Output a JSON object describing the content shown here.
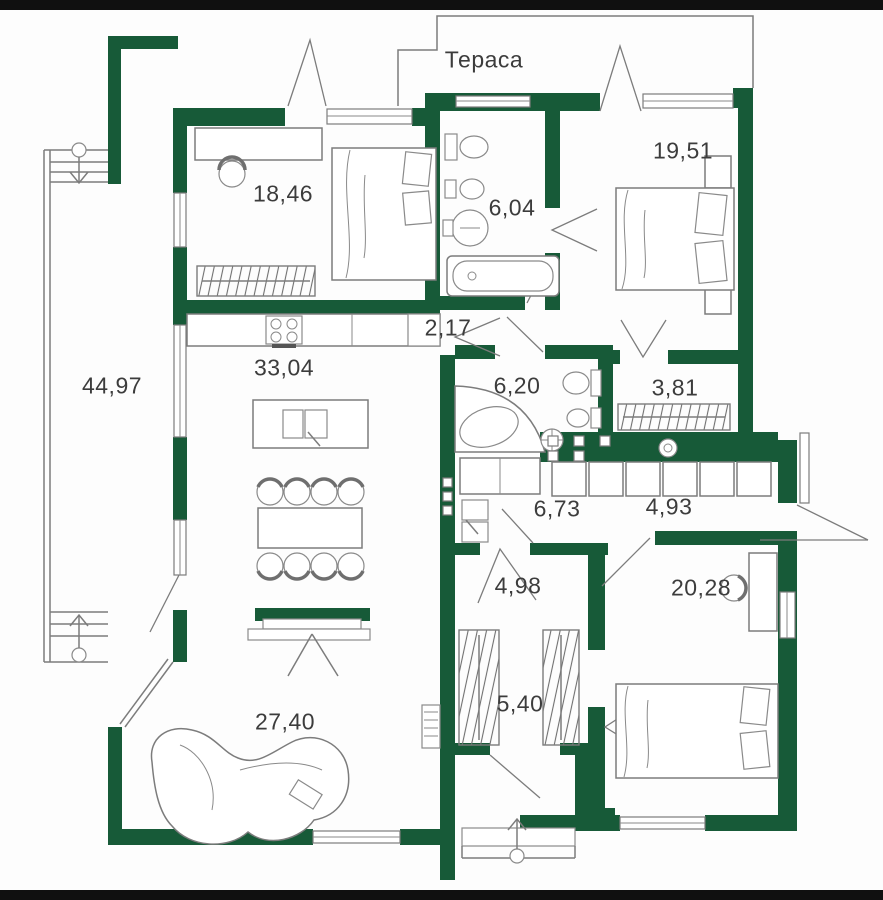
{
  "plan": {
    "title": "house-floor-plan",
    "colors": {
      "wall": "#175a38",
      "frame_bar": "#101010",
      "line": "#7c7c7c",
      "text": "#3c3c3c",
      "background": "#fdfdfd"
    },
    "rooms": [
      {
        "name": "terrace-top",
        "label": "Тераса",
        "x": 484,
        "y": 60
      },
      {
        "name": "bedroom-1",
        "area": "18,46",
        "x": 283,
        "y": 194
      },
      {
        "name": "bathroom-1",
        "area": "6,04",
        "x": 512,
        "y": 208
      },
      {
        "name": "bedroom-2",
        "area": "19,51",
        "x": 683,
        "y": 151
      },
      {
        "name": "corridor-1",
        "area": "2,17",
        "x": 448,
        "y": 328
      },
      {
        "name": "bathroom-2",
        "area": "6,20",
        "x": 517,
        "y": 386
      },
      {
        "name": "wardrobe-room",
        "area": "3,81",
        "x": 675,
        "y": 388
      },
      {
        "name": "terrace-left",
        "area": "44,97",
        "x": 112,
        "y": 386
      },
      {
        "name": "kitchen-dining",
        "area": "33,04",
        "x": 284,
        "y": 368
      },
      {
        "name": "utility-room",
        "area": "6,73",
        "x": 557,
        "y": 509
      },
      {
        "name": "entrance-hall",
        "area": "4,93",
        "x": 669,
        "y": 507
      },
      {
        "name": "corridor-2",
        "area": "4,98",
        "x": 518,
        "y": 586
      },
      {
        "name": "hallway-closet",
        "area": "5,40",
        "x": 520,
        "y": 704
      },
      {
        "name": "living-room",
        "area": "27,40",
        "x": 285,
        "y": 722
      },
      {
        "name": "bedroom-3",
        "area": "20,28",
        "x": 701,
        "y": 588
      }
    ],
    "icons": [
      "bed-icon",
      "double-bed-icon",
      "desk-icon",
      "chair-icon",
      "wardrobe-icon",
      "toilet-icon",
      "bidet-icon",
      "washbasin-icon",
      "bathtub-icon",
      "corner-bathtub-icon",
      "laundry-basket-icon",
      "kitchen-counter-icon",
      "stove-icon",
      "island-sink-icon",
      "dining-table-icon",
      "dining-chair-icon",
      "tv-fireplace-icon",
      "sofa-icon",
      "radiator-icon",
      "cabinet-icon",
      "washing-machine-icon",
      "stairs-icon",
      "entrance-arrow-icon"
    ]
  }
}
